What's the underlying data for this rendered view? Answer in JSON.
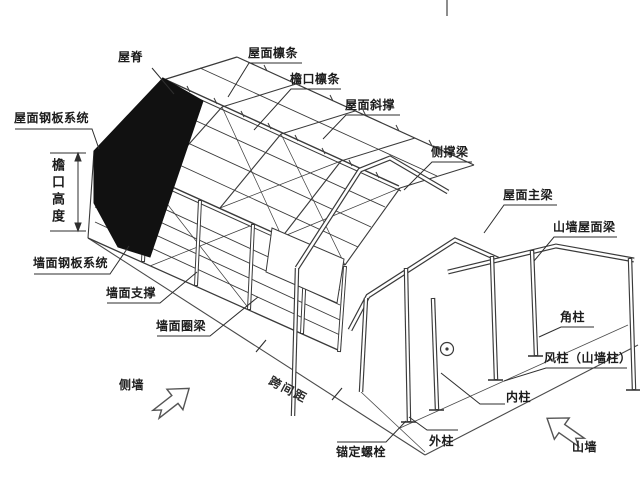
{
  "page": {
    "background": "#ffffff"
  },
  "diagram": {
    "type": "steel-structure-annotated-isometric",
    "line_color": "#3a3a3a",
    "panel_color": "#111111",
    "labels": {
      "ridge": "屋脊",
      "roof_purlin": "屋面檩条",
      "eave_purlin": "檐口檩条",
      "roof_brace": "屋面斜撑",
      "side_brace_beam": "侧撑梁",
      "roof_main_beam": "屋面主梁",
      "gable_roof_beam": "山墙屋面梁",
      "corner_column": "角柱",
      "wind_column": "风柱（山墙柱）",
      "inner_column": "内柱",
      "outer_column": "外柱",
      "anchor_bolt": "锚定螺栓",
      "wall_girt": "墙面圈梁",
      "wall_brace": "墙面支撑",
      "wall_panel_system": "墙面钢板系统",
      "roof_panel_system": "屋面钢板系统",
      "eave_height": "檐口高度",
      "bay_spacing": "跨间距",
      "side_wall": "侧墙",
      "gable_wall": "山墙"
    }
  }
}
